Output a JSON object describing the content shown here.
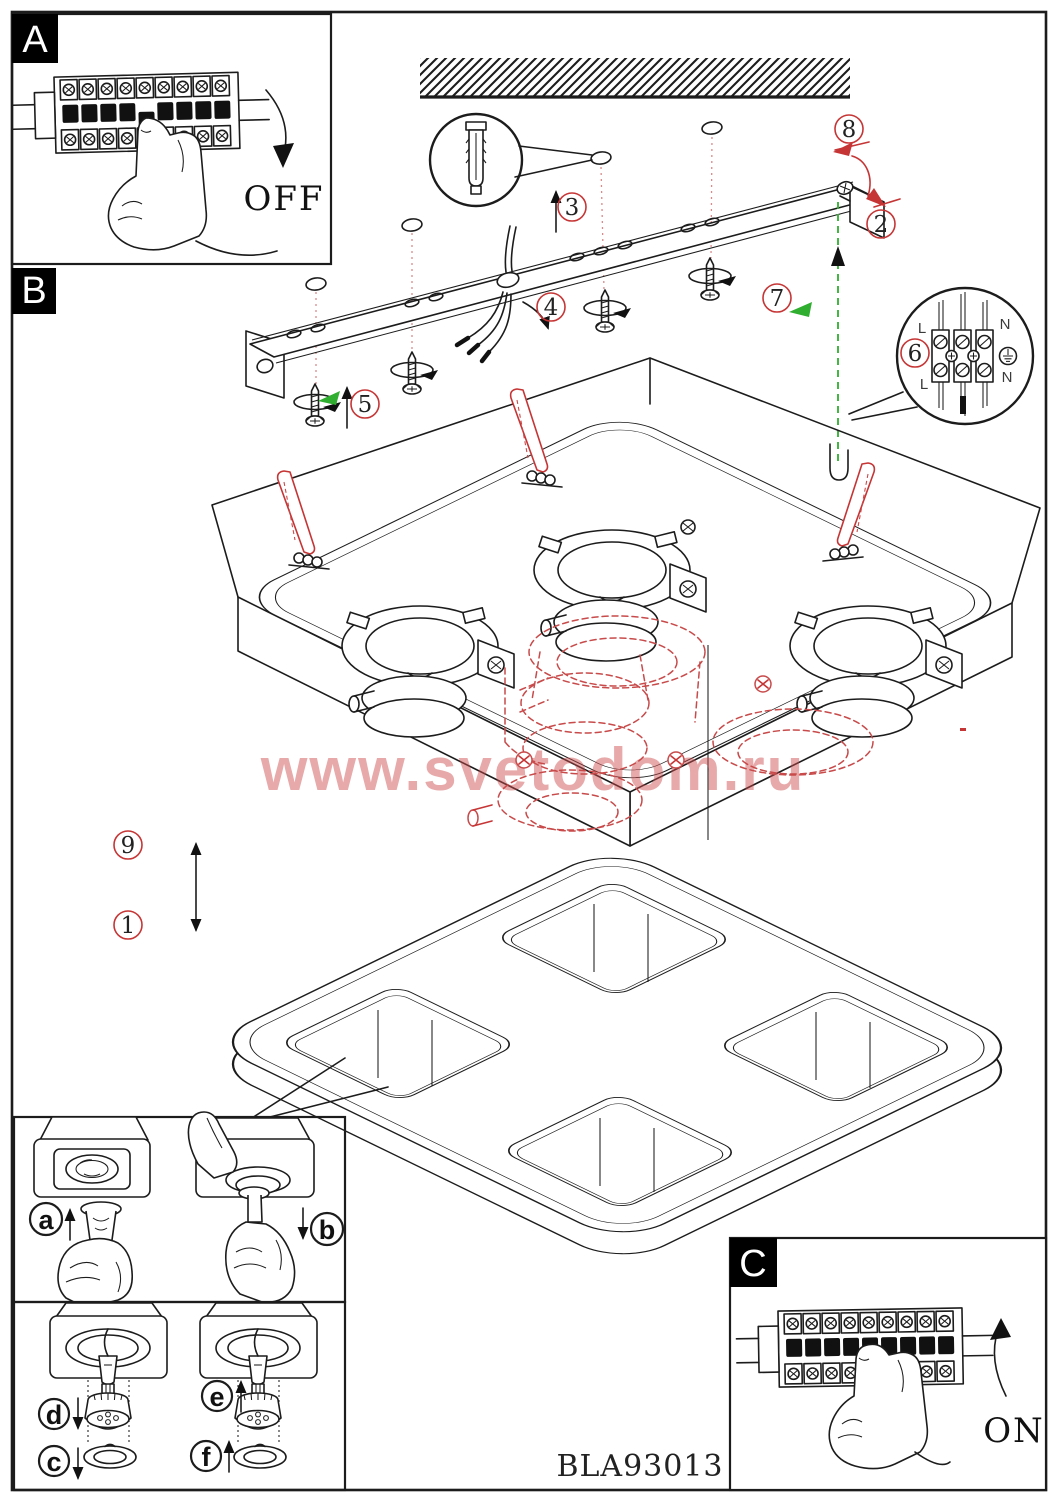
{
  "page": {
    "product_code": "BLA93013",
    "watermark": "www.svetodom.ru"
  },
  "panels": {
    "a": {
      "label": "A",
      "state": "OFF"
    },
    "b": {
      "label": "B"
    },
    "c": {
      "label": "C",
      "state": "ON"
    }
  },
  "steps": {
    "s1": "1",
    "s2": "2",
    "s3": "3",
    "s4": "4",
    "s5": "5",
    "s6": "6",
    "s7": "7",
    "s8": "8",
    "s9": "9"
  },
  "substeps": {
    "a": "a",
    "b": "b",
    "c": "c",
    "d": "d",
    "e": "e",
    "f": "f"
  },
  "terminal": {
    "l_top": "L",
    "n_top": "N",
    "l_bottom": "L",
    "n_bottom": "N"
  },
  "colors": {
    "ink": "#1c1c1c",
    "annotation_red": "#c63535",
    "annotation_green": "#2fae2f",
    "ghost_red": "#c84a4a",
    "watermark_red": "rgba(205,75,75,0.48)"
  }
}
